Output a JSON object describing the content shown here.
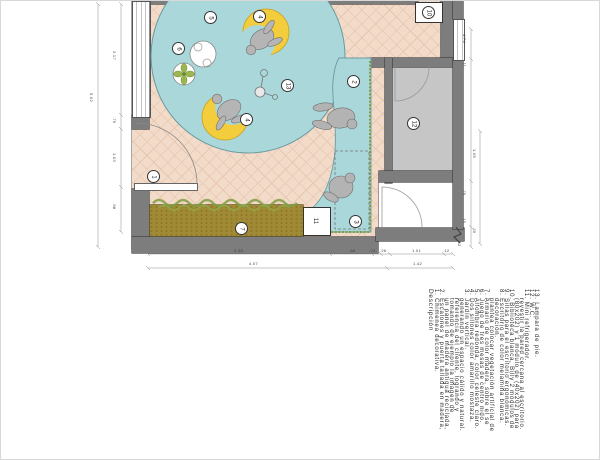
{
  "legend": {
    "heading": "Descripción",
    "lines": [
      {
        "text": "Descripción",
        "indent": false
      },
      {
        "text": "1.  Chimenea decorativa.",
        "indent": false
      },
      {
        "text": "2.  Escalones y puerta tallada en madera,",
        "indent": false
      },
      {
        "text": "un panel de madera antigua reciclada,",
        "indent": true
      },
      {
        "text": "tomando de ejemplo la imagen de",
        "indent": true
      },
      {
        "text": "referencia del cliente, logrando y",
        "indent": true
      },
      {
        "text": "generando un espacio cálido y natural.",
        "indent": true
      },
      {
        "text": "3.  Jardín vertical.",
        "indent": false
      },
      {
        "text": "4.  Dos sillones color amarillo mostaza.",
        "indent": false
      },
      {
        "text": "5.  Alfombra redonda, color celeste claro.",
        "indent": false
      },
      {
        "text": "6.  Juego de tres mesas de centro nido.",
        "indent": false
      },
      {
        "text": "7.  Armario de color madera, sobre el se",
        "indent": false
      },
      {
        "text": "plantea colocar vegetación artificial de",
        "indent": true
      },
      {
        "text": "decoración.",
        "indent": true
      },
      {
        "text": "8.  Escritorio de color melamina blanca.",
        "indent": false
      },
      {
        "text": "9.  Sillas para el escritorio ergonómicas.",
        "indent": false
      },
      {
        "text": "10. Biblioteca blanca, Billy 2 módulos de",
        "indent": false
      },
      {
        "text": "(80x202) y 1 módulo de (40x202) para",
        "indent": true
      },
      {
        "text": "revestir la pared cercana al escritorio.",
        "indent": true
      },
      {
        "text": "11. Mini refrigerador.",
        "indent": false
      },
      {
        "text": "12. W.C.",
        "indent": false
      },
      {
        "text": "13. Lampara de pie.",
        "indent": false
      }
    ]
  },
  "badges": [
    "1",
    "2",
    "3",
    "4",
    "4",
    "5",
    "6",
    "7",
    "10",
    "11",
    "12",
    "13"
  ],
  "dims": [
    "5.92",
    "2.17",
    ".79",
    "1.03",
    ".98",
    "3.38",
    ".88",
    ".23",
    ".26",
    "1.01",
    ".12",
    "4.07",
    "1.42",
    "4.74",
    ".11",
    "1.05",
    ".79",
    ".10",
    ".20",
    ".32"
  ],
  "colors": {
    "floor": "#f3dbc9",
    "lattice": "#e6c7b1",
    "rug_platform": "#a9d7da",
    "wall": "#7d7d7d",
    "armchair": "#f4cd3c",
    "wardrobe": "#a18a35",
    "hedge_green": "#7f9e43",
    "wc_floor": "#c6c6c6"
  }
}
